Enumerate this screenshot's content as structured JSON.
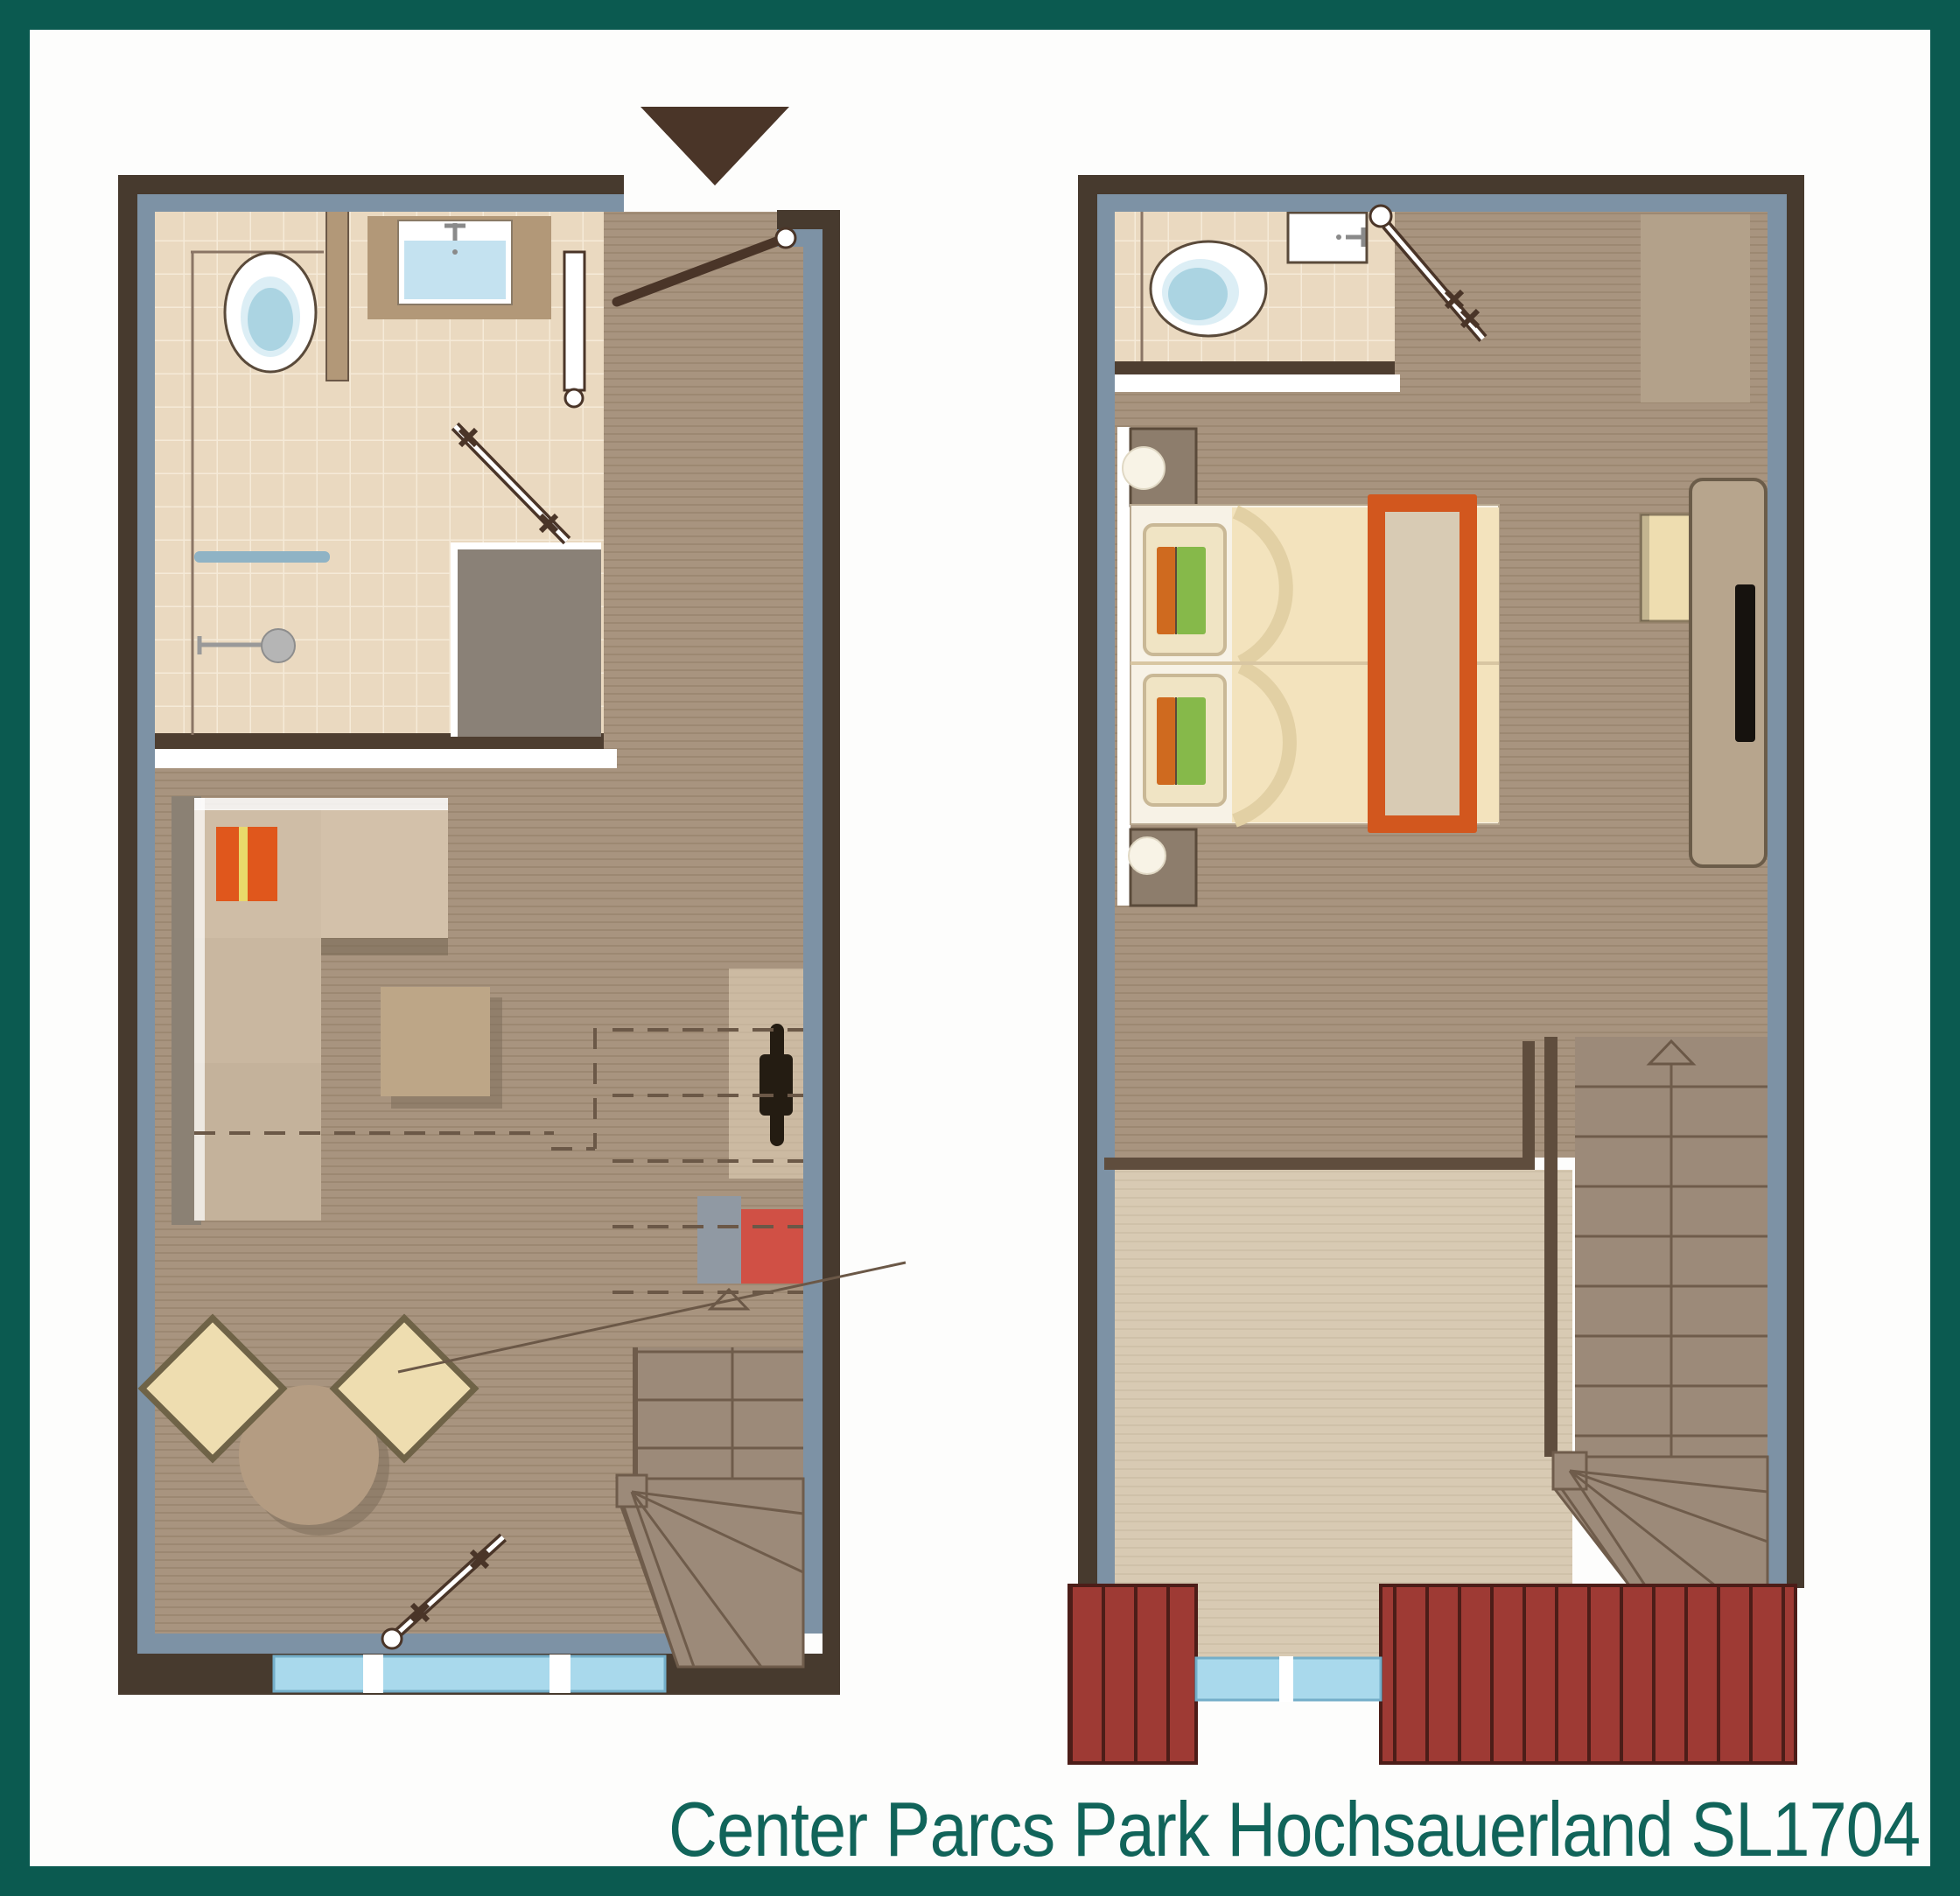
{
  "caption": {
    "text": "Center Parcs Park Hochsauerland SL1704"
  },
  "plans": {
    "ground": {
      "name": "ground-floor-plan"
    },
    "upper": {
      "name": "upper-floor-plan"
    }
  },
  "colors": {
    "frame-teal": "#0b5a50",
    "caption": "#11645a",
    "wall-brown": "#473a2e",
    "wall-blue": "#7d92a5",
    "tile": "#ead9c0",
    "tile-line": "#f5ead8",
    "wood": "#a8947f",
    "wood-line": "#9c8872",
    "wood-light": "#d8cab3",
    "wood-light-line": "#cfc1a9",
    "stair": "#9c8a79",
    "stair-line": "#6f5c4b",
    "deck-red": "#9e3a34",
    "deck-line": "#4c1d18",
    "window-blue": "#a9d9ec",
    "window-edge": "#74aec9",
    "dark-line": "#6b5847",
    "door-dark": "#4a3528",
    "counter-tan": "#b29878",
    "water-blue": "#c4e2f0",
    "toilet-blue": "#abd4e2",
    "toilet-blue-light": "#dceef5",
    "wardrobe-gray": "#8a8177",
    "sofa-back": "#8b8174",
    "sofa-seat": "#cfbda6",
    "sofa-seat2": "#c9b7a0",
    "sofa-seat3": "#c4b29b",
    "chaise": "#d3c1aa",
    "cushion-orange": "#e0571c",
    "cushion-stripe": "#e9d96b",
    "ottoman": "#bda687",
    "shadow-brown": "#7a6a57",
    "table-wood": "#b49c82",
    "chair-cream": "#eeddb0",
    "chair-edge": "#6f6347",
    "radiator-black": "#241c12",
    "box-gray": "#9099a3",
    "box-red": "#d05045",
    "bed-white": "#f7f2e6",
    "bed-edge": "#b8a88f",
    "duvet-cream": "#f3e3bd",
    "duvet-fold": "#e2d0a4",
    "pillow-base": "#f0e4c4",
    "pillow-edge": "#c9b896",
    "pillow-green": "#86b94a",
    "pillow-orange": "#cf6a1f",
    "runner-orange": "#d2571e",
    "runner-fill": "#d8cbb4",
    "nightstand": "#8d7d6c",
    "lamp-white": "#f8f3e6",
    "closet-tan": "#b3a18a",
    "desk-tan": "#b7a58d",
    "desk-edge": "#6b5c49",
    "tv-black": "#16120e",
    "fixture-gray": "#b5b5b5"
  }
}
